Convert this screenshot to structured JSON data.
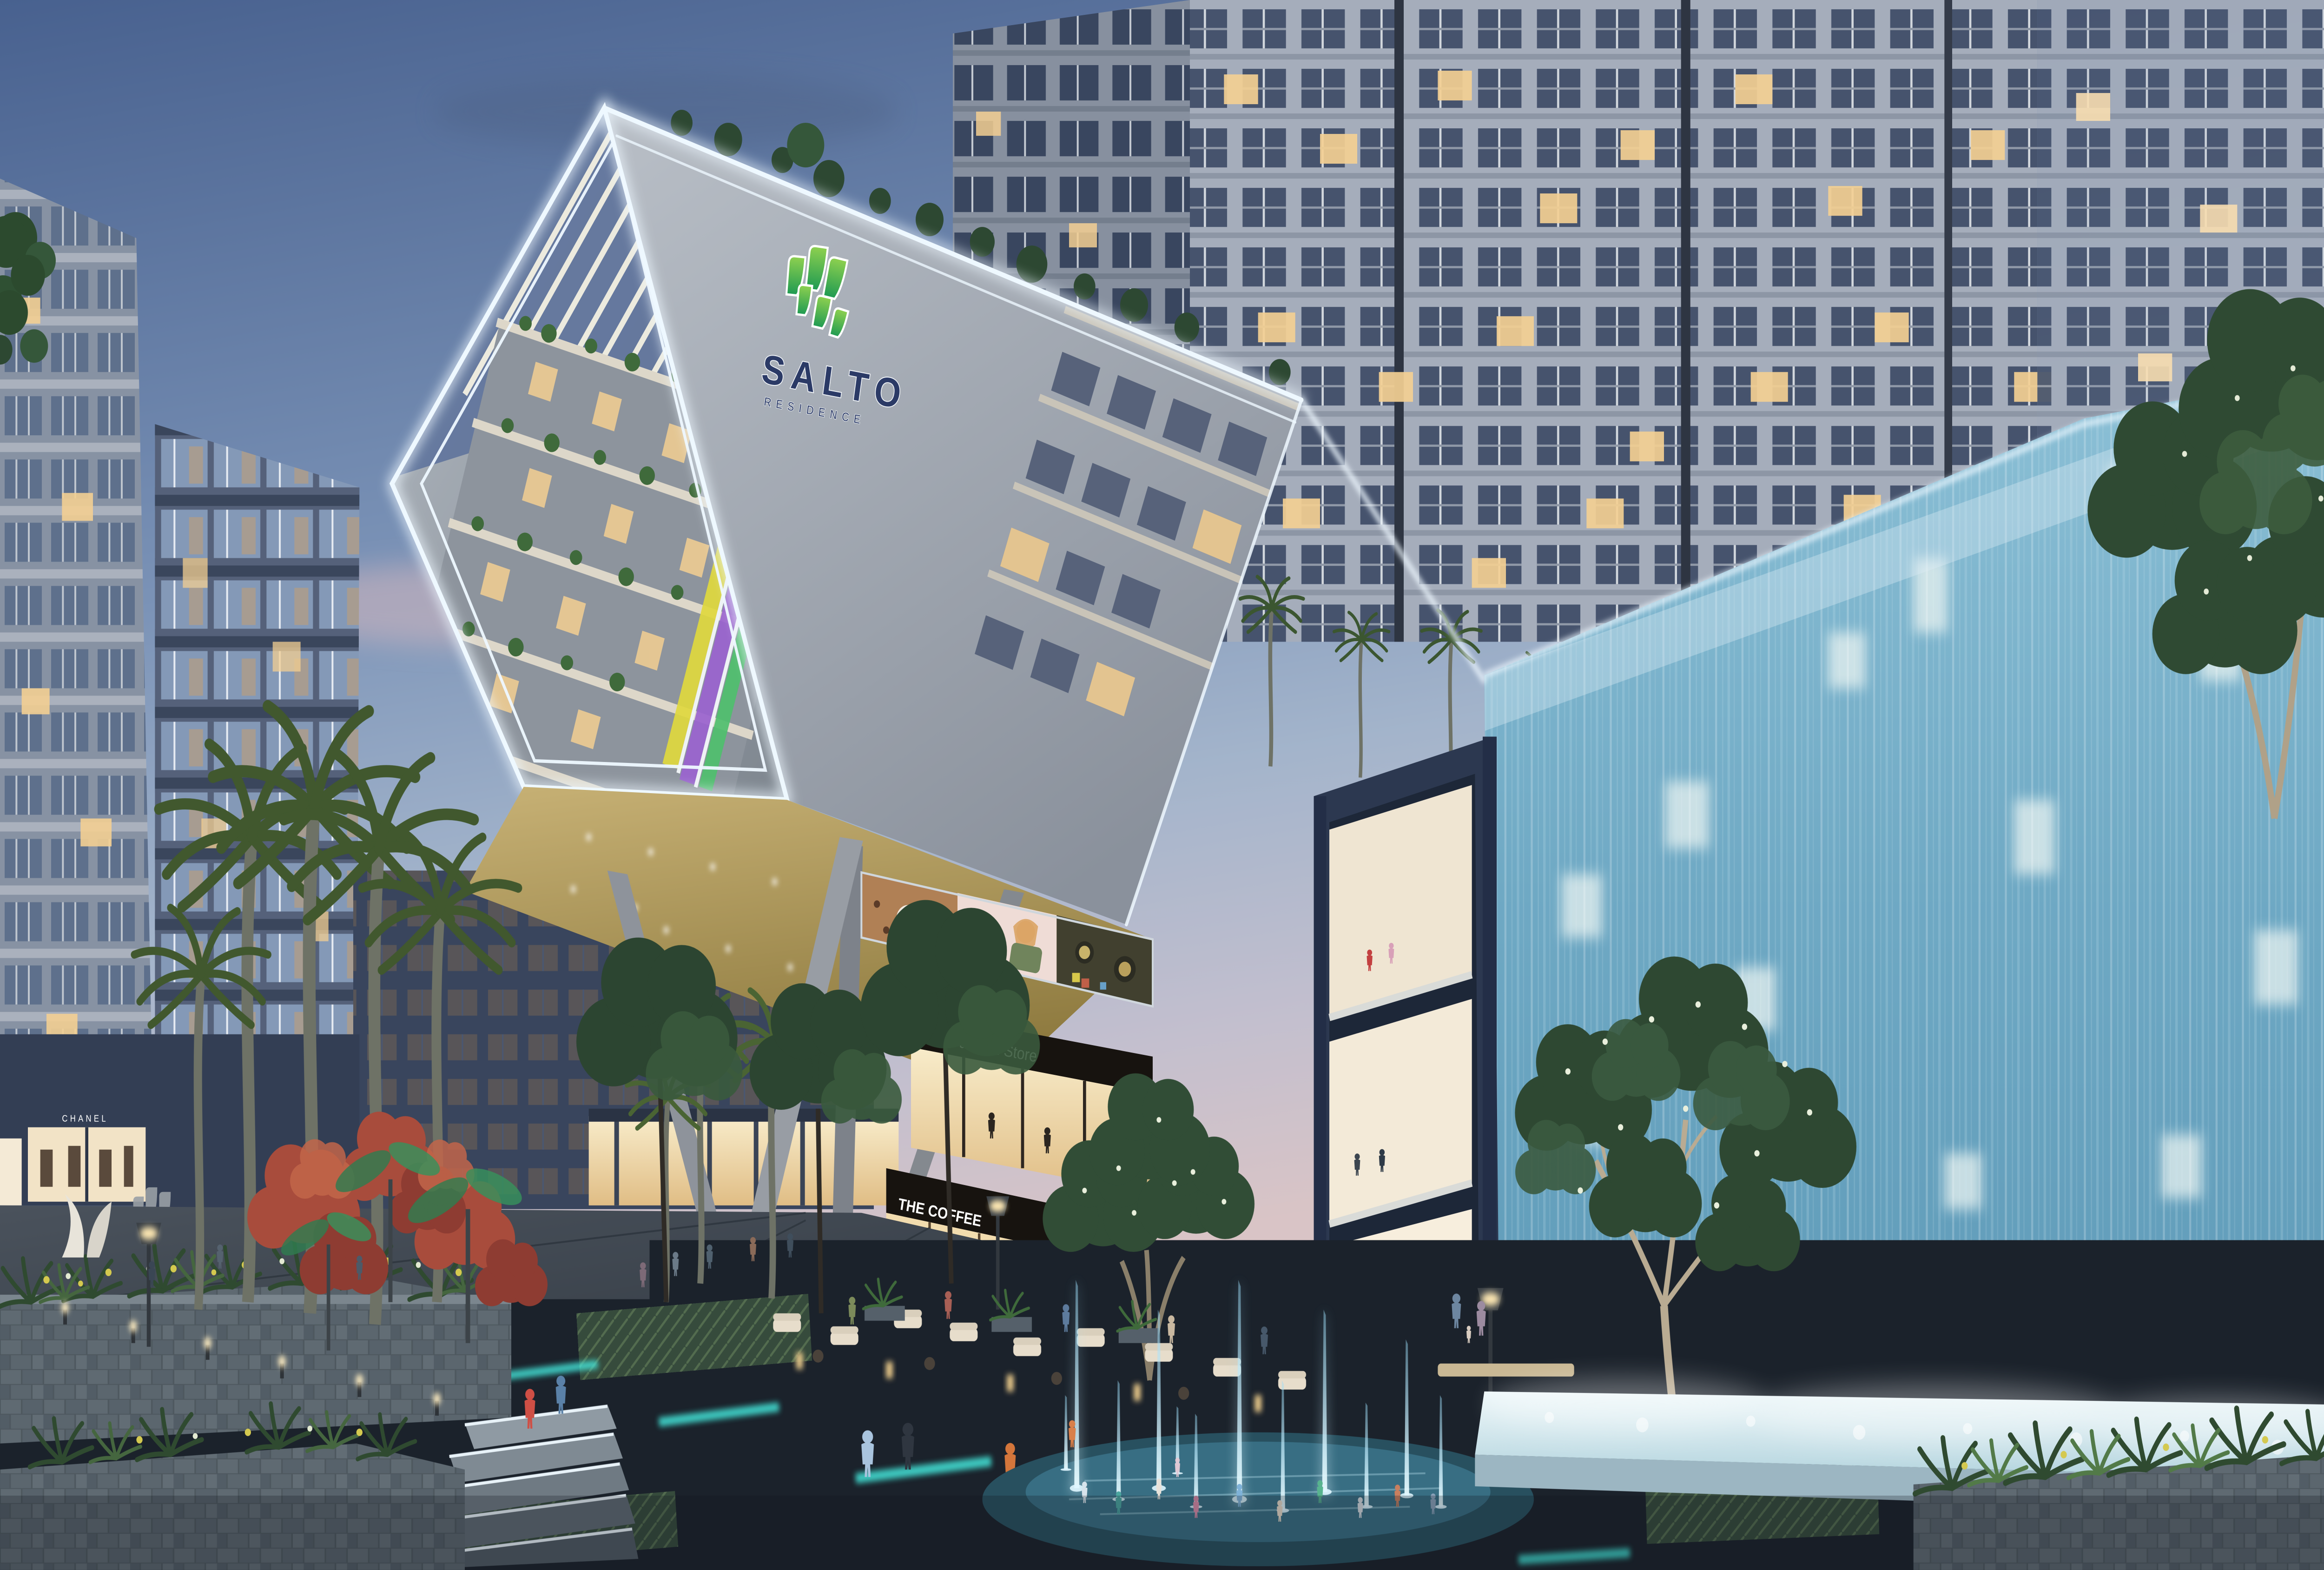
{
  "scene": {
    "setting": "Mixed-use residential complex plaza at dusk",
    "signs": {
      "logo_name": "SALTO",
      "logo_subtitle": "RESIDENCE",
      "fashion_store": "Fashion Store",
      "coffee_shop": "THE COFFEE",
      "boutique": "CHANEL",
      "billboard": {
        "line1": "a",
        "line2": "new",
        "line3": "day"
      }
    },
    "palette": {
      "sky_top": "#48618f",
      "sky_horizon": "#d9c4c6",
      "led_white": "#eef8ff",
      "facade_grey": "#aab1ba",
      "logo_navy": "#2b3a66",
      "leaf_green_light": "#8fd14f",
      "leaf_green_dark": "#1e9a52",
      "waterfall_blue": "#6fa9c4",
      "fountain_jet": "#b4ecff",
      "teal_led": "#45e8dc",
      "warm_window": "#f3cf92",
      "sign_band": "#17130f",
      "sign_text": "#ffffff",
      "red_foliage": "#a84c3c",
      "wood_soffit": "#b49d62"
    },
    "features": [
      "LED-framed cantilevered residence building",
      "glass waterfall wall with glowing windows",
      "children's splash fountain",
      "retail promenade",
      "rooftop palm gardens",
      "illuminated planter walkway"
    ]
  }
}
